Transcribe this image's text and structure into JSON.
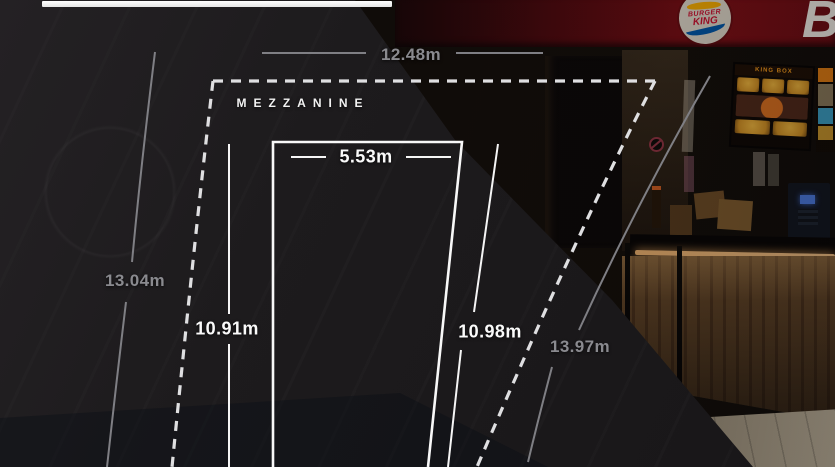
{
  "plan": {
    "area_label": "MEZZANINE",
    "dimensions": {
      "top_width": "12.48m",
      "outer_left": "13.04m",
      "inner_left": "10.91m",
      "inner_width": "5.53m",
      "inner_right": "10.98m",
      "outer_right": "13.97m"
    }
  },
  "photo": {
    "brand": "BURGER KING",
    "logo_line1": "BURGER",
    "logo_line2": "KING",
    "sign_letter": "B",
    "menu_board_title": "KING BOX"
  },
  "colors": {
    "overlay_black": "#1d1b1d",
    "dimension_gray": "#8a8a8f",
    "line_white": "#f8f8f8",
    "dashed_white": "#dfdfe1",
    "sign_red": "#7b0d13",
    "led_warm": "#f4c285"
  }
}
